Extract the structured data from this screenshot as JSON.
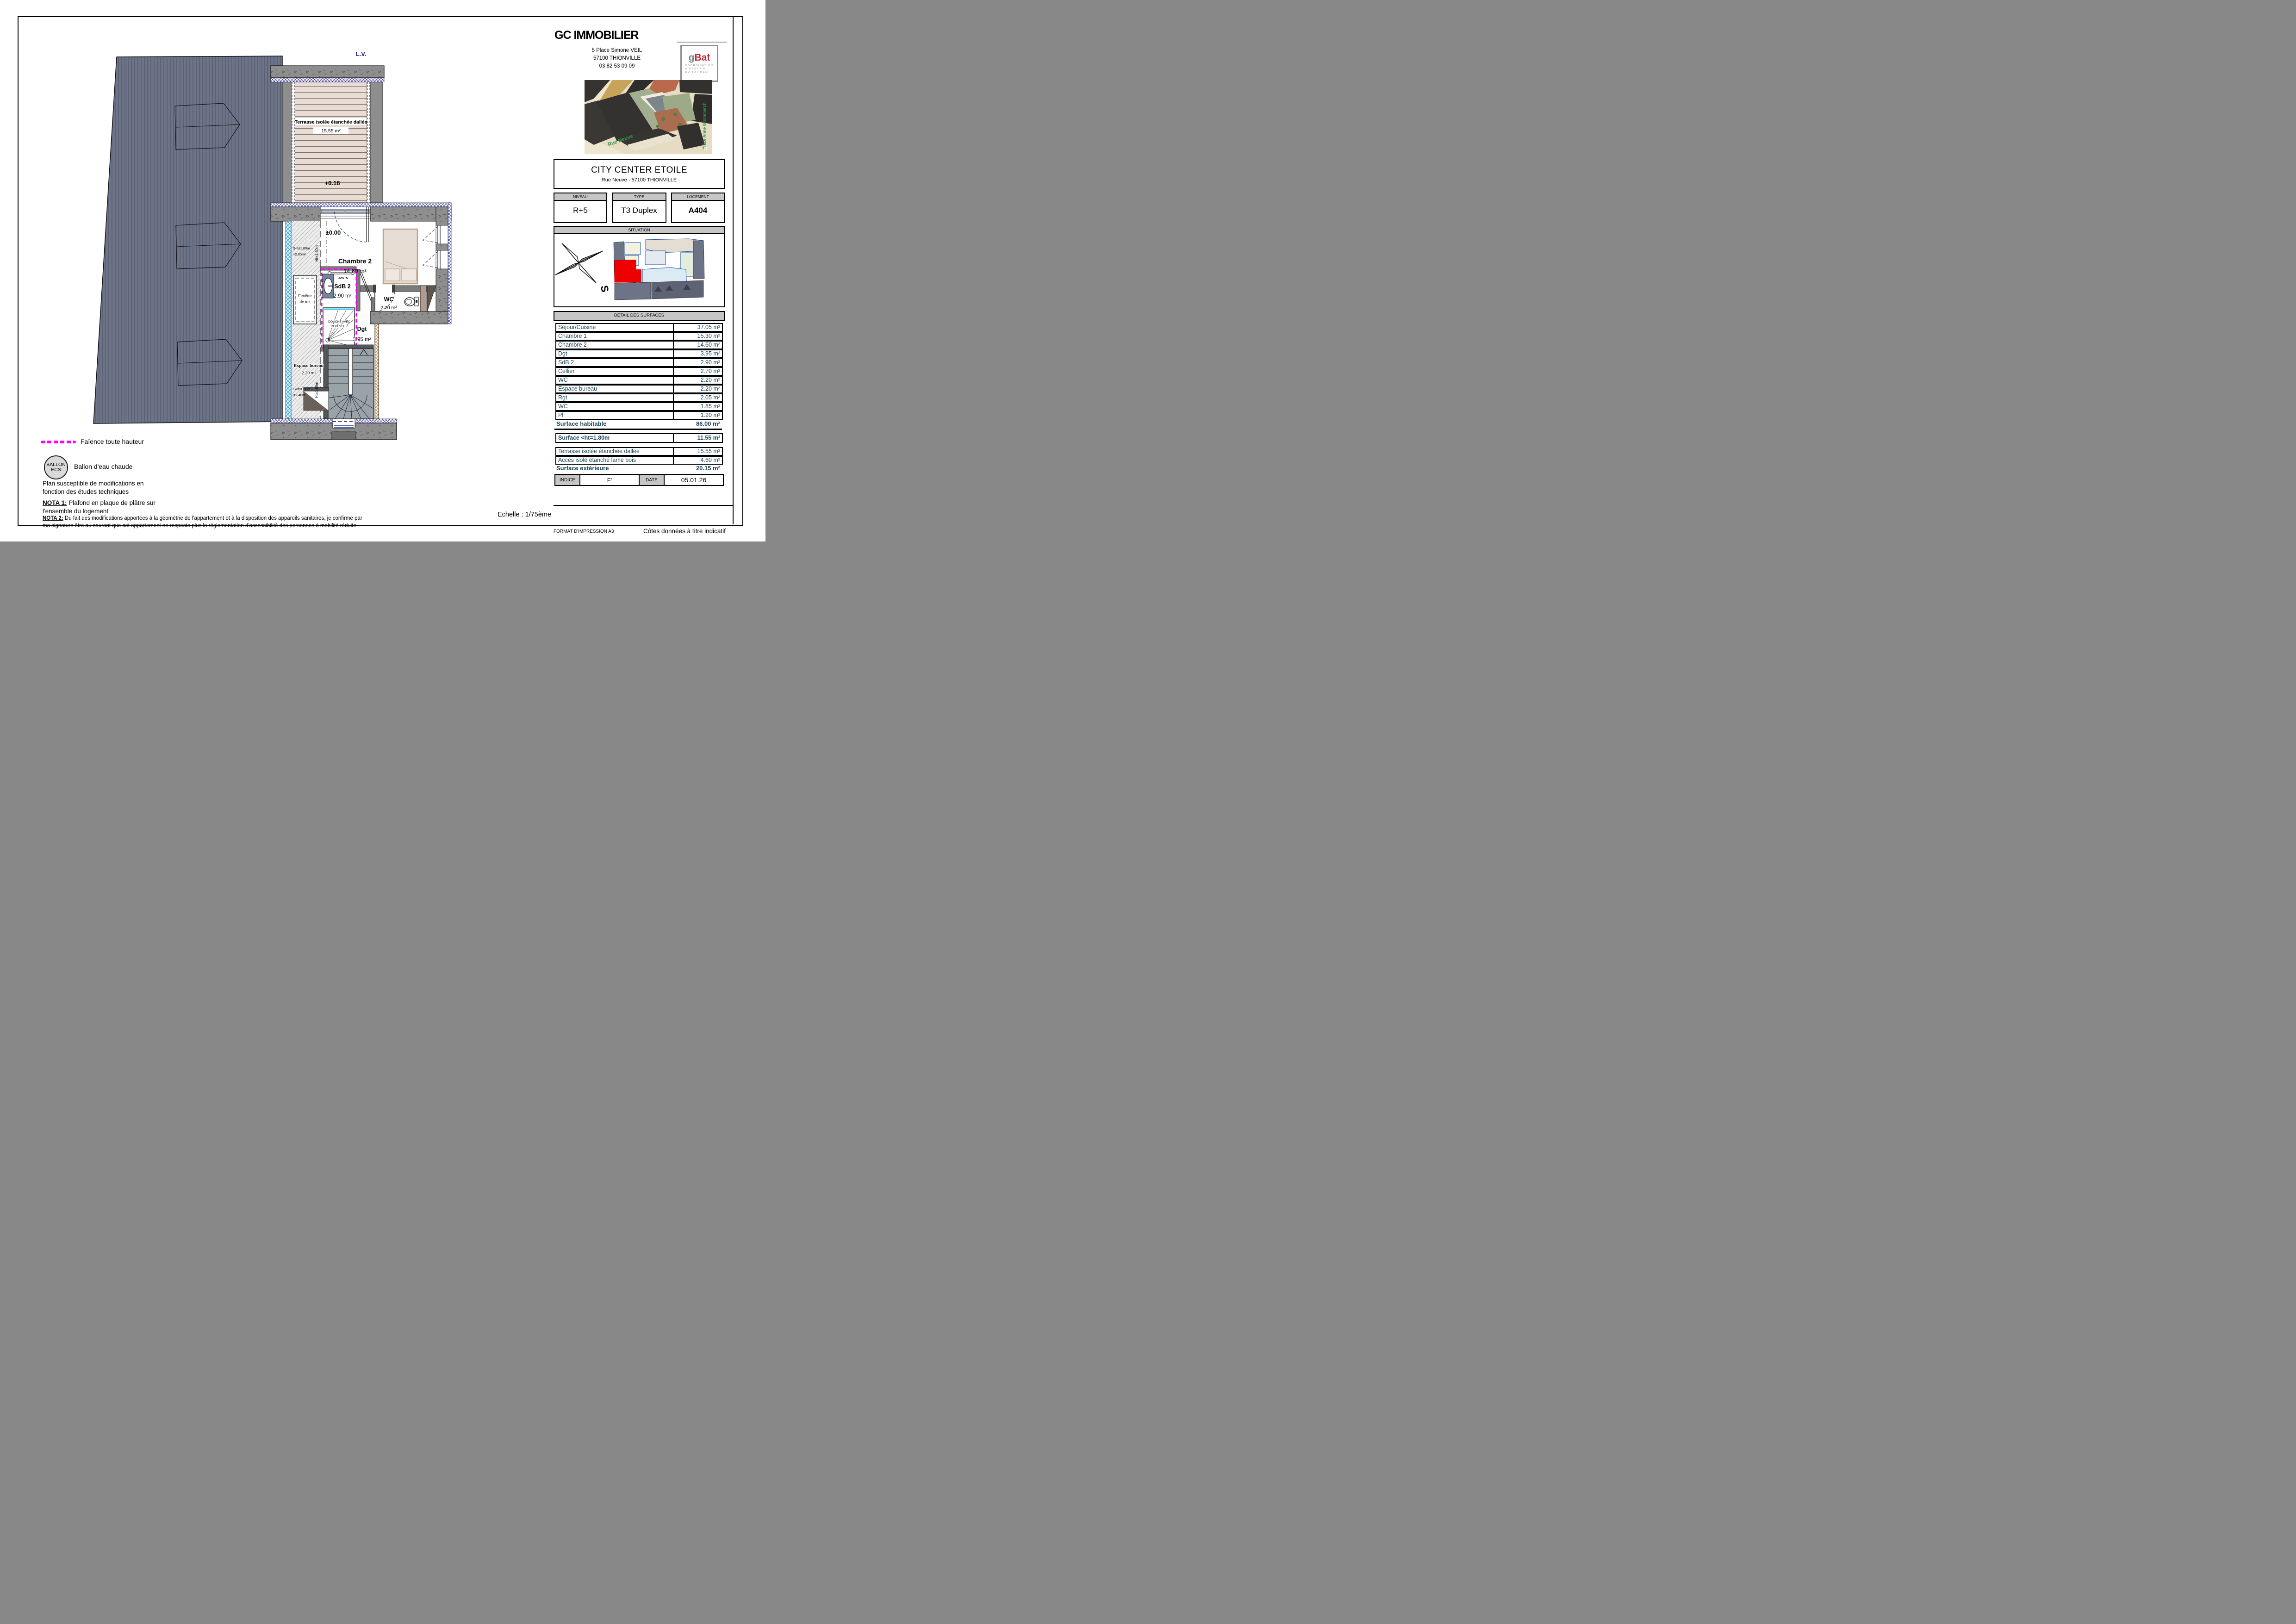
{
  "header": {
    "company": "GC IMMOBILIER",
    "address1": "5 Place Simone VEIL",
    "address2": "57100 THIONVILLE",
    "phone": "03 82 53 09 09"
  },
  "logo": {
    "g": "g",
    "bat": "Bat",
    "line1": "COORDINATION",
    "line2": "& GESTION",
    "line3": "DU BATIMENT"
  },
  "photo": {
    "street1": "Rue Neuve",
    "street2": "Place Anne Grommerch",
    "north": "N"
  },
  "project": {
    "title": "CITY CENTER ETOILE",
    "address": "Rue Neuve - 57100 THIONVILLE"
  },
  "info": {
    "niveau_label": "NIVEAU",
    "niveau_value": "R+5",
    "type_label": "TYPE",
    "type_value": "T3 Duplex",
    "logement_label": "LOGEMENT",
    "logement_value": "A404"
  },
  "situation": {
    "title": "SITUATION",
    "compass": "S"
  },
  "surfaces": {
    "title": "DETAIL DES SURFACES",
    "rows": [
      {
        "label": "Séjour/Cuisine",
        "value": "37.05 m²"
      },
      {
        "label": "Chambre 1",
        "value": "15.30 m²"
      },
      {
        "label": "Chambre 2",
        "value": "14.60 m²"
      },
      {
        "label": "Dgt",
        "value": "3.95 m²"
      },
      {
        "label": "SdB 2",
        "value": "2.90 m²"
      },
      {
        "label": "Cellier",
        "value": "2.70 m²"
      },
      {
        "label": "WC",
        "value": "2.20 m²"
      },
      {
        "label": "Espace bureau",
        "value": "2.20 m²"
      },
      {
        "label": "Rgt",
        "value": "2.05 m²"
      },
      {
        "label": "WC",
        "value": "1.85 m²"
      },
      {
        "label": "Pl",
        "value": "1.20 m²"
      }
    ],
    "habitable_label": "Surface habitable",
    "habitable_value": "86.00 m²",
    "under_label": "Surface <ht=1.80m",
    "under_value": "11.55 m²",
    "ext_rows": [
      {
        "label": "Terrasse isolée étanchée dallée",
        "value": "15.55 m²"
      },
      {
        "label": "Accès isolé étanché lame bois",
        "value": "4.60 m²"
      }
    ],
    "ext_label": "Surface extérieure",
    "ext_value": "20.15 m²"
  },
  "indice": {
    "label": "INDICE",
    "value": "F'",
    "date_label": "DATE",
    "date_value": "05.01.26"
  },
  "plan": {
    "lv": "L.V.",
    "terrasse_name": "Terrasse isolée étanchée dallée",
    "terrasse_area": "15.55 m²",
    "terrasse_level": "+0.18",
    "level_zero": "±0.00",
    "chambre2_name": "Chambre 2",
    "chambre2_area": "14.60 m²",
    "fenetre1": "Fenêtre",
    "fenetre2": "de toit",
    "s_ht_upper1": "S<ht1.80m",
    "s_ht_upper2": "=2.00m²",
    "ht_line": "Ht=1.80m",
    "s_ht_lower1": "S<ht1.80m",
    "s_ht_lower2": "=2.40m²",
    "sdb2_name": "SdB 2",
    "sdb2_area": "2.90 m²",
    "s_ser": "S. Ser.",
    "douche1": "DOUCHE AVEC",
    "douche2": "RECEVEUR",
    "wc_name": "WC",
    "wc_area": "2.20 m²",
    "dgt_name": "Dgt",
    "dgt_area": "3.95 m²",
    "bureau_name": "Espace bureau",
    "bureau_area": "2.20 m²"
  },
  "legend": {
    "faience": "Faïence toute hauteur",
    "ballon_line1": "BALLON",
    "ballon_line2": "ECS",
    "ballon_label": "Ballon d'eau chaude",
    "disclaimer1": "Plan susceptible de modifications en",
    "disclaimer2": "fonction des études techniques",
    "nota1_label": "NOTA 1:",
    "nota1_text": " Plafond en plaque de plâtre sur",
    "nota1_text2": "l'ensemble du logement",
    "nota2_label": "NOTA 2:",
    "nota2_text": " Du fait des modifications apportées à la géométrie de l'appartement et à la disposition des appareils sanitaires, je confirme par",
    "nota2_text2": "ma signature être au courant que cet appartement ne respecte plus la réglementation d'accessibilité des personnes à mobilité réduite.",
    "echelle": "Echelle : 1/75ème"
  },
  "footer": {
    "format": "FORMAT D'IMPRESSION A3",
    "cotes": "Côtes données à titre indicatif"
  }
}
